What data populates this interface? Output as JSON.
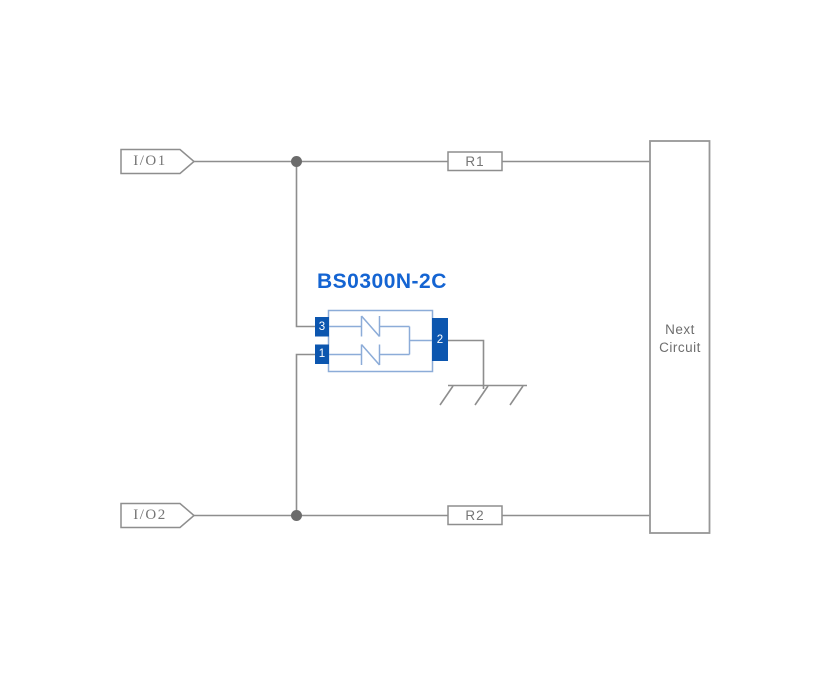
{
  "component": {
    "title": "BS0300N-2C",
    "pins": {
      "pin1": "1",
      "pin2": "2",
      "pin3": "3"
    }
  },
  "labels": {
    "io1": "I/O1",
    "io2": "I/O2",
    "r1": "R1",
    "r2": "R2"
  },
  "next_circuit": {
    "line1": "Next",
    "line2": "Circuit"
  },
  "colors": {
    "wire_gray": "#8e8e8e",
    "text_gray": "#757575",
    "junction_gray": "#6b6b6b",
    "component_blue": "#0c56af",
    "component_light_blue": "#8cacd8",
    "title_blue": "#1464d2"
  }
}
